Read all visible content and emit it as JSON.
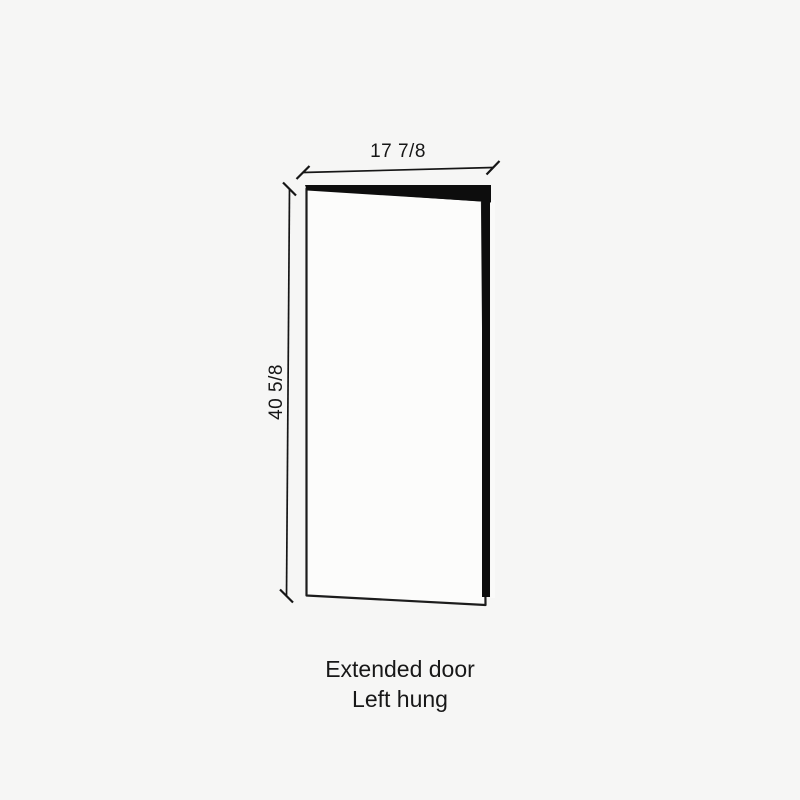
{
  "page": {
    "background_color": "#f6f6f5"
  },
  "diagram": {
    "type": "door-elevation-drawing",
    "width_dimension": "17 7/8",
    "height_dimension": "40 5/8",
    "caption": {
      "line1": "Extended door",
      "line2": "Left hung"
    },
    "colors": {
      "ink": "#161616",
      "door_face": "#fcfcfb",
      "door_edge_fill": "#0d0d0d",
      "background": "#f6f6f5"
    }
  }
}
